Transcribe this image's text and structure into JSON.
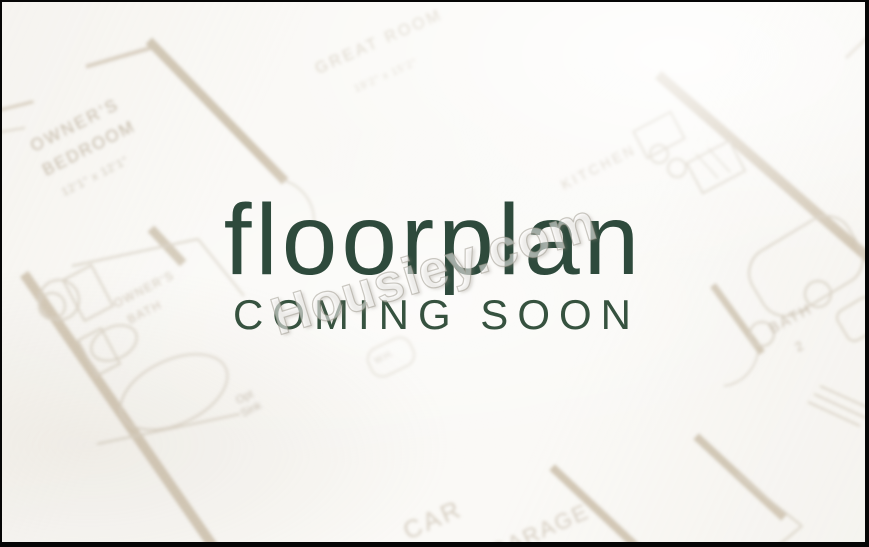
{
  "overlay": {
    "title": "floorplan",
    "subtitle": "COMING SOON",
    "accent_color": "#2e4a3c",
    "accent_color_light": "#36523f"
  },
  "watermark": {
    "text": "Housiey.com"
  },
  "floorplan_sheet": {
    "wall_color": "#cdc1ae",
    "thin_line_color": "#d9d1c4",
    "label_color": "#c3b8a7",
    "labels": {
      "owners_bedroom_1": "OWNER'S",
      "owners_bedroom_2": "BEDROOM",
      "owners_bedroom_dims": "12'1\" x 12'1\"",
      "great_room": "GREAT ROOM",
      "great_room_dims": "19'2\" x 15'2\"",
      "kitchen": "KITCHEN",
      "owners_bath_1": "OWNER'S",
      "owners_bath_2": "BATH",
      "bath2_1": "BATH",
      "bath2_2": "2",
      "opt_sink_1": "Opt",
      "opt_sink_2": "Sink",
      "water_heater": "W.H.",
      "garage_1": "CAR",
      "garage_2": "GARAGE"
    }
  }
}
